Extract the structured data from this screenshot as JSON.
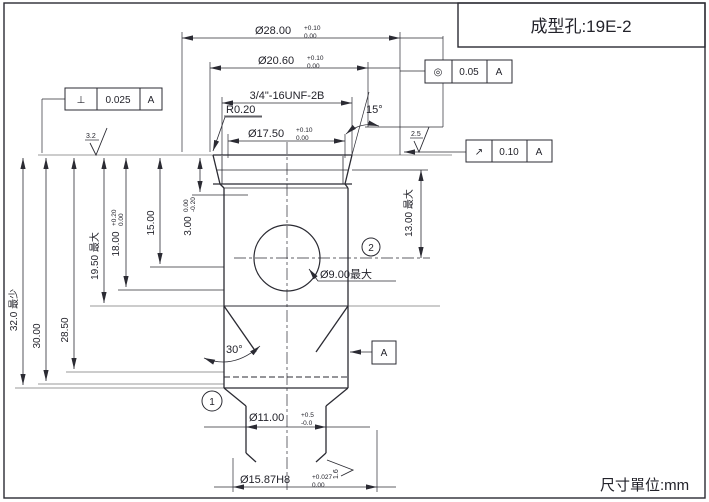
{
  "title_box": {
    "label": "成型孔:19E-2"
  },
  "units_note": "尺寸單位:mm",
  "dimensions": {
    "d28": {
      "main": "Ø28.00",
      "tol_up": "+0.10",
      "tol_dn": "0.00"
    },
    "d206": {
      "main": "Ø20.60",
      "tol_up": "+0.10",
      "tol_dn": "0.00"
    },
    "thread": "3/4\"-16UNF-2B",
    "r020": "R0.20",
    "d175": {
      "main": "Ø17.50",
      "tol_up": "+0.10",
      "tol_dn": "0.00"
    },
    "a15": "15°",
    "a30": "30°",
    "h32": "32.0 最少",
    "h30": "30.00",
    "h285": "28.50",
    "h195": "19.50 最大",
    "h18": {
      "main": "18.00",
      "tol_up": "+0.20",
      "tol_dn": "0.00"
    },
    "h15": "15.00",
    "h3": {
      "main": "3.00",
      "tol_up": "0.00",
      "tol_dn": "-0.20"
    },
    "h13": "13.00 最大",
    "d9": "Ø9.00最大",
    "d11": {
      "main": "Ø11.00",
      "tol_up": "+0.5",
      "tol_dn": "-0.0"
    },
    "d1587": {
      "main": "Ø15.87H8",
      "tol_up": "+0.027",
      "tol_dn": "0.00"
    }
  },
  "gdt": {
    "perpendicularity": {
      "symbol": "⊥",
      "value": "0.025",
      "datum": "A"
    },
    "concentricity": {
      "symbol": "◎",
      "value": "0.05",
      "datum": "A"
    },
    "runout": {
      "symbol": "↗",
      "value": "0.10",
      "datum": "A"
    },
    "datum_flag": "A"
  },
  "surface_finish": {
    "top": "3.2",
    "right": "2.5",
    "bottom": "1.6"
  },
  "balloons": {
    "b1": "1",
    "b2": "2"
  },
  "colors": {
    "line": "#2b2b33",
    "gray_line": "#9a9a9a"
  }
}
